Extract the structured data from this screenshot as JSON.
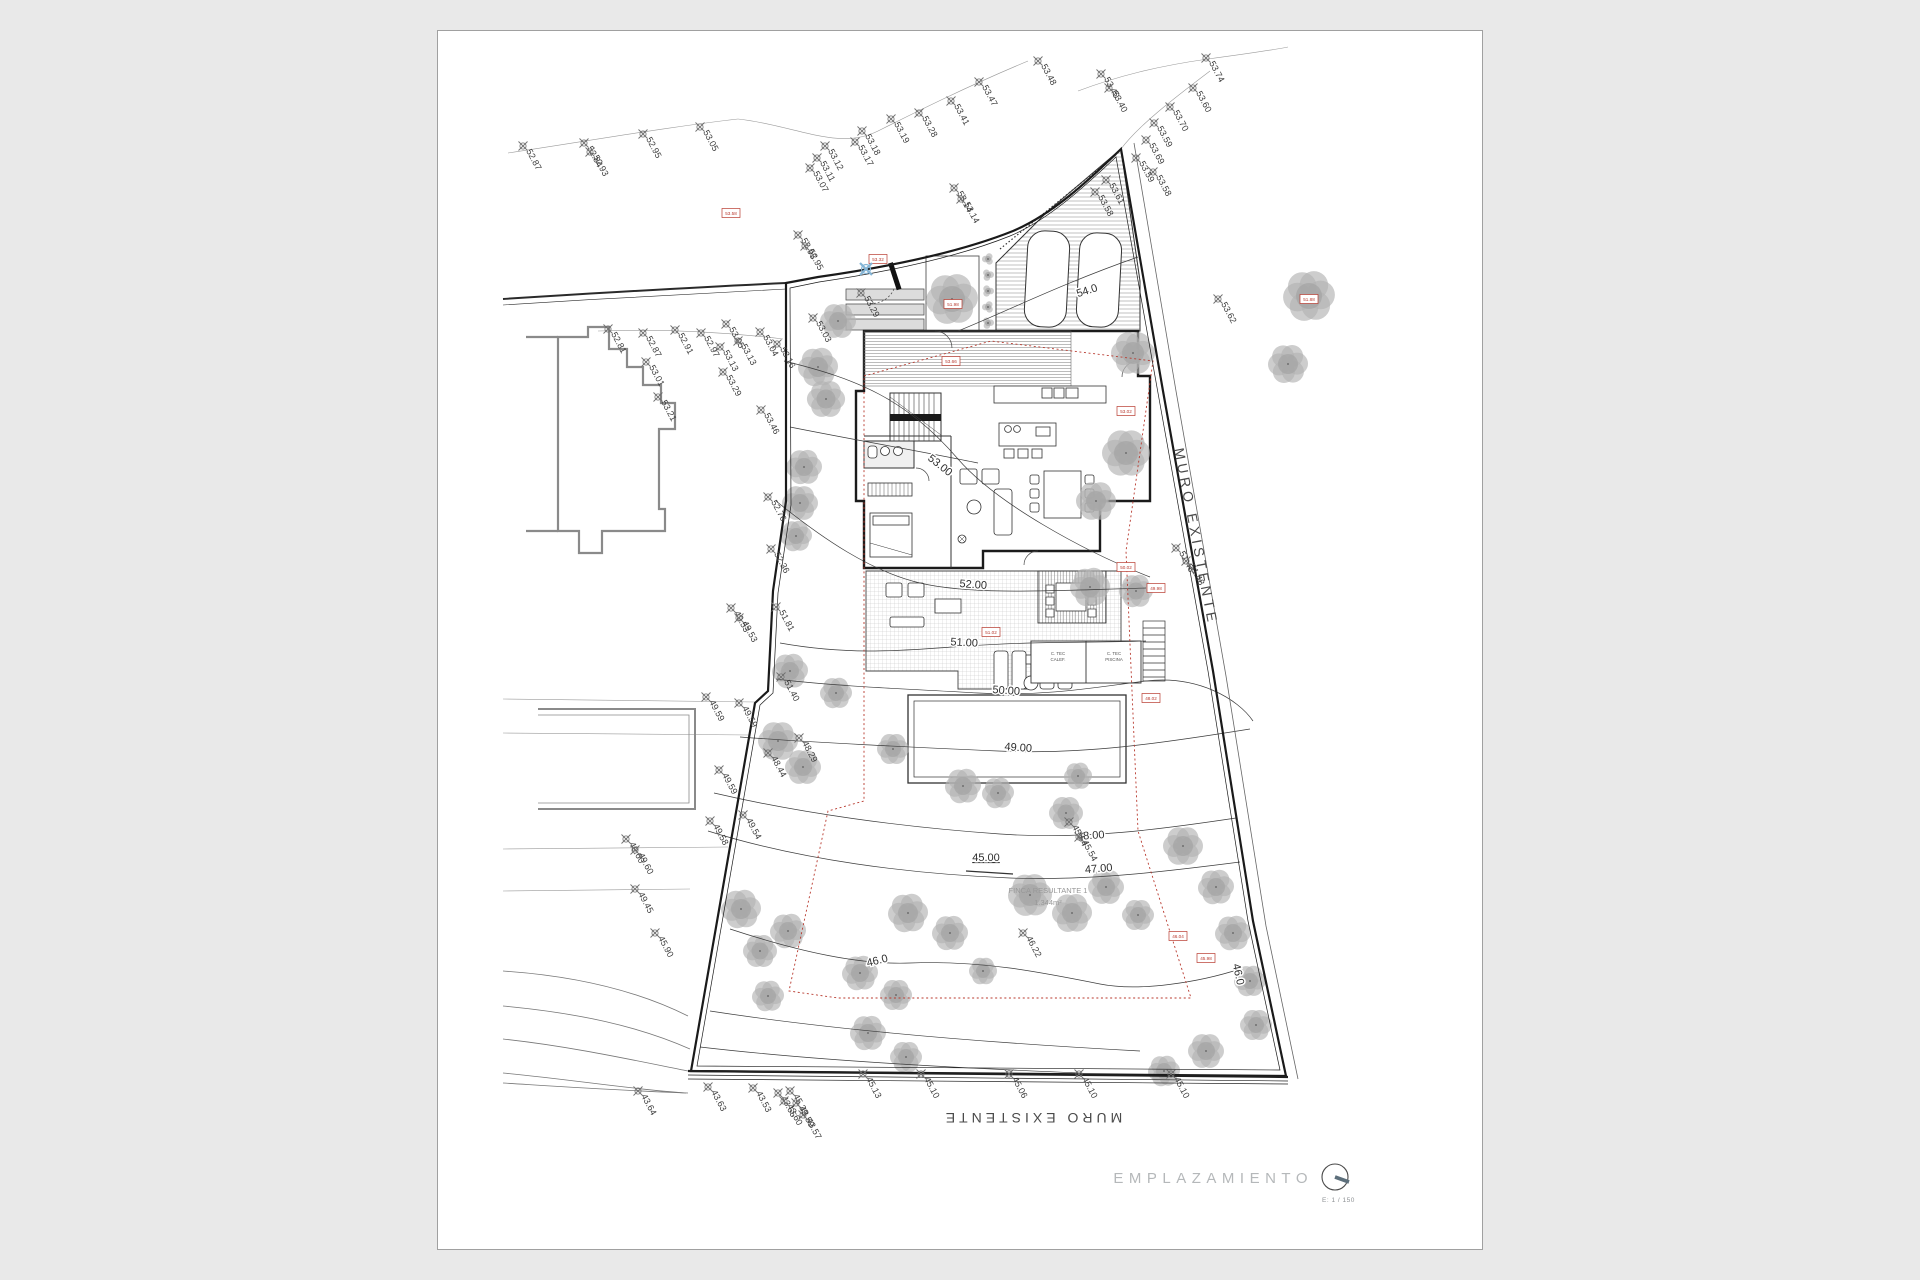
{
  "colors": {
    "background": "#e9e9e9",
    "sheet": "#ffffff",
    "line_dark": "#1f1f1f",
    "line_light": "#8f8f8f",
    "tree": "#b2b2b2",
    "red": "#b8392e",
    "blue_marker": "#85b5d6",
    "title_gray": "#b5b8ba"
  },
  "title_block": {
    "title": "EMPLAZAMIENTO",
    "scale_label": "E: 1 / 150"
  },
  "wall_labels": {
    "right": "MURO EXISTENTE",
    "bottom": "MURO EXISTENTE"
  },
  "parcel_label": {
    "line1": "FINCA RESULTANTE 1",
    "line2": "1.344m²"
  },
  "tech_rooms": [
    {
      "l1": "C. TEC",
      "l2": "CALEF.",
      "x": 620,
      "y": 624
    },
    {
      "l1": "C. TEC",
      "l2": "PISCINA",
      "x": 676,
      "y": 624
    }
  ],
  "garden_step_label": {
    "t": "45.00",
    "x": 548,
    "y": 830
  },
  "contour_labels": [
    {
      "t": "54.0",
      "x": 650,
      "y": 263,
      "r": -18
    },
    {
      "t": "53.00",
      "x": 500,
      "y": 437,
      "r": 38
    },
    {
      "t": "52.00",
      "x": 535,
      "y": 557,
      "r": 4
    },
    {
      "t": "51.00",
      "x": 526,
      "y": 615,
      "r": 3
    },
    {
      "t": "50.00",
      "x": 568,
      "y": 663,
      "r": 4
    },
    {
      "t": "49.00",
      "x": 580,
      "y": 720,
      "r": 4
    },
    {
      "t": "48.00",
      "x": 653,
      "y": 808,
      "r": -4
    },
    {
      "t": "47.00",
      "x": 661,
      "y": 841,
      "r": -5
    },
    {
      "t": "46.0",
      "x": 440,
      "y": 933,
      "r": -14
    },
    {
      "t": "46.0",
      "x": 797,
      "y": 944,
      "r": 78
    }
  ],
  "survey_points": [
    [
      85,
      115,
      "52.87"
    ],
    [
      146,
      112,
      "52.84"
    ],
    [
      152,
      121,
      "52.93"
    ],
    [
      205,
      103,
      "52.95"
    ],
    [
      262,
      96,
      "53.05"
    ],
    [
      387,
      115,
      "53.12"
    ],
    [
      379,
      127,
      "53.11"
    ],
    [
      372,
      137,
      "53.07"
    ],
    [
      424,
      100,
      "53.18"
    ],
    [
      417,
      111,
      "53.17"
    ],
    [
      453,
      88,
      "53.19"
    ],
    [
      481,
      82,
      "53.28"
    ],
    [
      513,
      70,
      "53.41"
    ],
    [
      541,
      51,
      "53.47"
    ],
    [
      600,
      30,
      "53.48"
    ],
    [
      663,
      43,
      "53.40"
    ],
    [
      671,
      57,
      "53.40"
    ],
    [
      768,
      27,
      "53.74"
    ],
    [
      755,
      57,
      "53.60"
    ],
    [
      732,
      76,
      "53.70"
    ],
    [
      716,
      92,
      "53.59"
    ],
    [
      708,
      109,
      "53.69"
    ],
    [
      698,
      127,
      "53.59"
    ],
    [
      715,
      141,
      "53.58"
    ],
    [
      668,
      149,
      "53.61"
    ],
    [
      657,
      161,
      "53.58"
    ],
    [
      780,
      268,
      "53.62"
    ],
    [
      360,
      204,
      "52.95"
    ],
    [
      367,
      215,
      "52.95"
    ],
    [
      516,
      157,
      "53.14"
    ],
    [
      523,
      168,
      "53.14"
    ],
    [
      170,
      298,
      "52.81"
    ],
    [
      205,
      302,
      "52.87"
    ],
    [
      237,
      299,
      "52.91"
    ],
    [
      263,
      302,
      "52.97"
    ],
    [
      288,
      293,
      "53.05"
    ],
    [
      300,
      310,
      "53.13"
    ],
    [
      322,
      301,
      "53.04"
    ],
    [
      339,
      313,
      "53.16"
    ],
    [
      208,
      331,
      "53.01"
    ],
    [
      282,
      316,
      "53.13"
    ],
    [
      285,
      341,
      "53.29"
    ],
    [
      220,
      366,
      "53.21"
    ],
    [
      423,
      262,
      "53.29"
    ],
    [
      375,
      287,
      "53.03"
    ],
    [
      323,
      379,
      "53.46"
    ],
    [
      330,
      466,
      "52.76"
    ],
    [
      333,
      518,
      "52.36"
    ],
    [
      293,
      577,
      "49.53"
    ],
    [
      301,
      587,
      "49.53"
    ],
    [
      338,
      576,
      "51.81"
    ],
    [
      343,
      646,
      "51.40"
    ],
    [
      268,
      666,
      "49.59"
    ],
    [
      301,
      672,
      "49.59"
    ],
    [
      361,
      707,
      "48.29"
    ],
    [
      330,
      722,
      "48.44"
    ],
    [
      281,
      739,
      "49.59"
    ],
    [
      272,
      790,
      "49.58"
    ],
    [
      305,
      784,
      "49.54"
    ],
    [
      188,
      808,
      "49.60"
    ],
    [
      197,
      819,
      "49.60"
    ],
    [
      197,
      858,
      "49.45"
    ],
    [
      217,
      902,
      "45.90"
    ],
    [
      200,
      1060,
      "43.64"
    ],
    [
      270,
      1056,
      "43.63"
    ],
    [
      315,
      1057,
      "43.53"
    ],
    [
      340,
      1062,
      "43.65"
    ],
    [
      352,
      1060,
      "45.39"
    ],
    [
      358,
      1072,
      "43.59"
    ],
    [
      365,
      1084,
      "43.57"
    ],
    [
      346,
      1070,
      "43.60"
    ],
    [
      425,
      1043,
      "45.13"
    ],
    [
      483,
      1043,
      "45.10"
    ],
    [
      571,
      1043,
      "45.06"
    ],
    [
      641,
      1043,
      "45.10"
    ],
    [
      733,
      1043,
      "45.10"
    ],
    [
      585,
      902,
      "46.22"
    ],
    [
      631,
      791,
      "45.54"
    ],
    [
      641,
      806,
      "45.54"
    ],
    [
      738,
      517,
      "51.48"
    ],
    [
      748,
      530,
      "51.48"
    ]
  ],
  "red_tags": [
    [
      293,
      182,
      "53.58"
    ],
    [
      440,
      228,
      "53.32"
    ],
    [
      515,
      273,
      "51.98"
    ],
    [
      871,
      268,
      "51.88"
    ],
    [
      513,
      330,
      "53.66"
    ],
    [
      688,
      380,
      "53.02"
    ],
    [
      553,
      601,
      "51.02"
    ],
    [
      688,
      536,
      "50.02"
    ],
    [
      718,
      557,
      "49.98"
    ],
    [
      713,
      667,
      "48.02"
    ],
    [
      740,
      905,
      "46.04"
    ],
    [
      768,
      927,
      "45.98"
    ]
  ],
  "trees": [
    [
      400,
      290,
      18
    ],
    [
      380,
      336,
      20
    ],
    [
      388,
      368,
      19
    ],
    [
      366,
      436,
      18
    ],
    [
      362,
      472,
      18
    ],
    [
      358,
      505,
      16
    ],
    [
      514,
      268,
      26
    ],
    [
      871,
      265,
      26
    ],
    [
      850,
      333,
      20
    ],
    [
      695,
      322,
      22
    ],
    [
      688,
      422,
      24
    ],
    [
      658,
      470,
      20
    ],
    [
      652,
      556,
      20
    ],
    [
      698,
      560,
      17
    ],
    [
      352,
      640,
      18
    ],
    [
      398,
      662,
      16
    ],
    [
      340,
      710,
      20
    ],
    [
      365,
      736,
      18
    ],
    [
      303,
      878,
      20
    ],
    [
      322,
      920,
      17
    ],
    [
      350,
      900,
      18
    ],
    [
      330,
      965,
      16
    ],
    [
      470,
      882,
      20
    ],
    [
      512,
      902,
      18
    ],
    [
      422,
      942,
      18
    ],
    [
      458,
      964,
      16
    ],
    [
      545,
      940,
      14
    ],
    [
      592,
      864,
      22
    ],
    [
      634,
      882,
      20
    ],
    [
      668,
      856,
      18
    ],
    [
      700,
      884,
      16
    ],
    [
      745,
      815,
      20
    ],
    [
      778,
      856,
      18
    ],
    [
      795,
      902,
      18
    ],
    [
      812,
      950,
      16
    ],
    [
      818,
      994,
      16
    ],
    [
      768,
      1020,
      18
    ],
    [
      726,
      1040,
      16
    ],
    [
      430,
      1002,
      18
    ],
    [
      468,
      1026,
      16
    ],
    [
      640,
      745,
      14
    ],
    [
      455,
      718,
      16
    ],
    [
      525,
      755,
      18
    ],
    [
      560,
      762,
      16
    ],
    [
      628,
      782,
      17
    ],
    [
      550,
      228,
      6
    ],
    [
      550,
      244,
      6
    ],
    [
      550,
      260,
      6
    ],
    [
      550,
      276,
      6
    ],
    [
      550,
      292,
      6
    ]
  ]
}
